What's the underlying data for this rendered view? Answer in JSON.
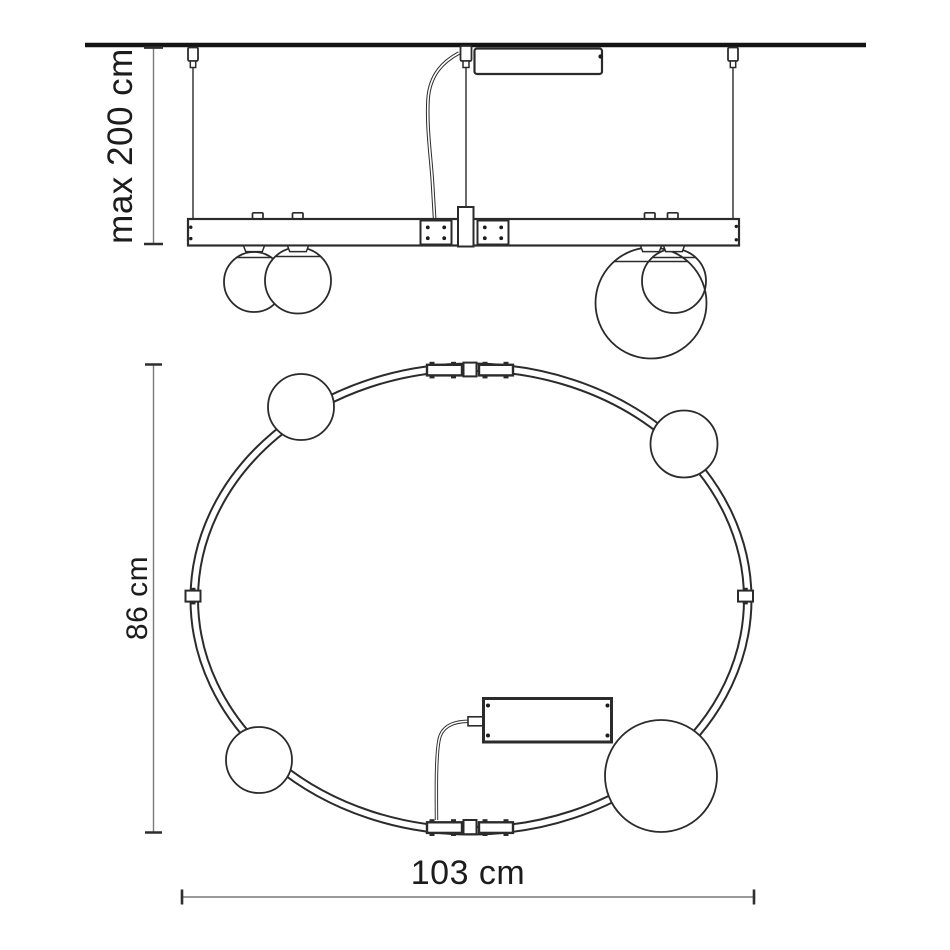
{
  "labels": {
    "suspension_height": "max 200 cm",
    "ring_depth": "86 cm",
    "ring_width": "103 cm"
  },
  "values": {
    "suspension_max_cm": 200,
    "ring_depth_cm": 86,
    "ring_width_cm": 103
  },
  "colors": {
    "line": "#2b2b2b",
    "ceiling": "#141414",
    "dim_line": "#7a7a7a",
    "dim_tick": "#2e2e2e",
    "text": "#1c1c1c",
    "background": "#ffffff"
  }
}
